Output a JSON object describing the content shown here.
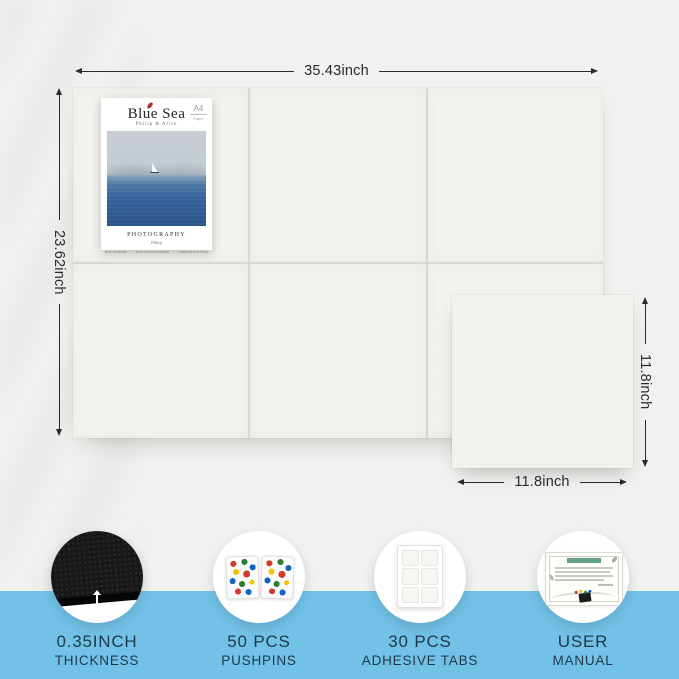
{
  "dimensions": {
    "board_width": "35.43inch",
    "board_height": "23.62inch",
    "tile_height": "11.8inch",
    "tile_width": "11.8inch"
  },
  "poster": {
    "title": "Blue Sea",
    "subtitle": "Philip & Alice",
    "paper_badge": {
      "size": "A4",
      "type": "Paper"
    },
    "caption_title": "PHOTOGRAPHY",
    "caption_author": "Philip",
    "footnotes": [
      "Blue simplicity",
      "Blue sea and sailboat",
      "Supported by Sony"
    ],
    "footnote_separator": "|"
  },
  "features": [
    {
      "icon": "felt-thickness-icon",
      "value": "0.35INCH",
      "label": "THICKNESS"
    },
    {
      "icon": "pushpin-boxes-icon",
      "value": "50 PCS",
      "label": "PUSHPINS"
    },
    {
      "icon": "adhesive-tabs-icon",
      "value": "30 PCS",
      "label": "ADHESIVE TABS"
    },
    {
      "icon": "user-manual-icon",
      "value": "USER",
      "label": "MANUAL"
    }
  ],
  "colors": {
    "band_blue": "#72c2e7",
    "background_gray": "#f1f1ef",
    "tile_offwhite": "#f4f3ee",
    "felt_black": "#171717",
    "feature_text": "#21384a",
    "dimension_text": "#2a2a2a",
    "poster_leaf_red": "#a93226",
    "sea_blue": "#2b5587",
    "manual_header_green": "#64a08c",
    "pin_colors": [
      "#d63b2f",
      "#2e7d32",
      "#1565c0",
      "#f3c511",
      "#ffffff"
    ]
  }
}
